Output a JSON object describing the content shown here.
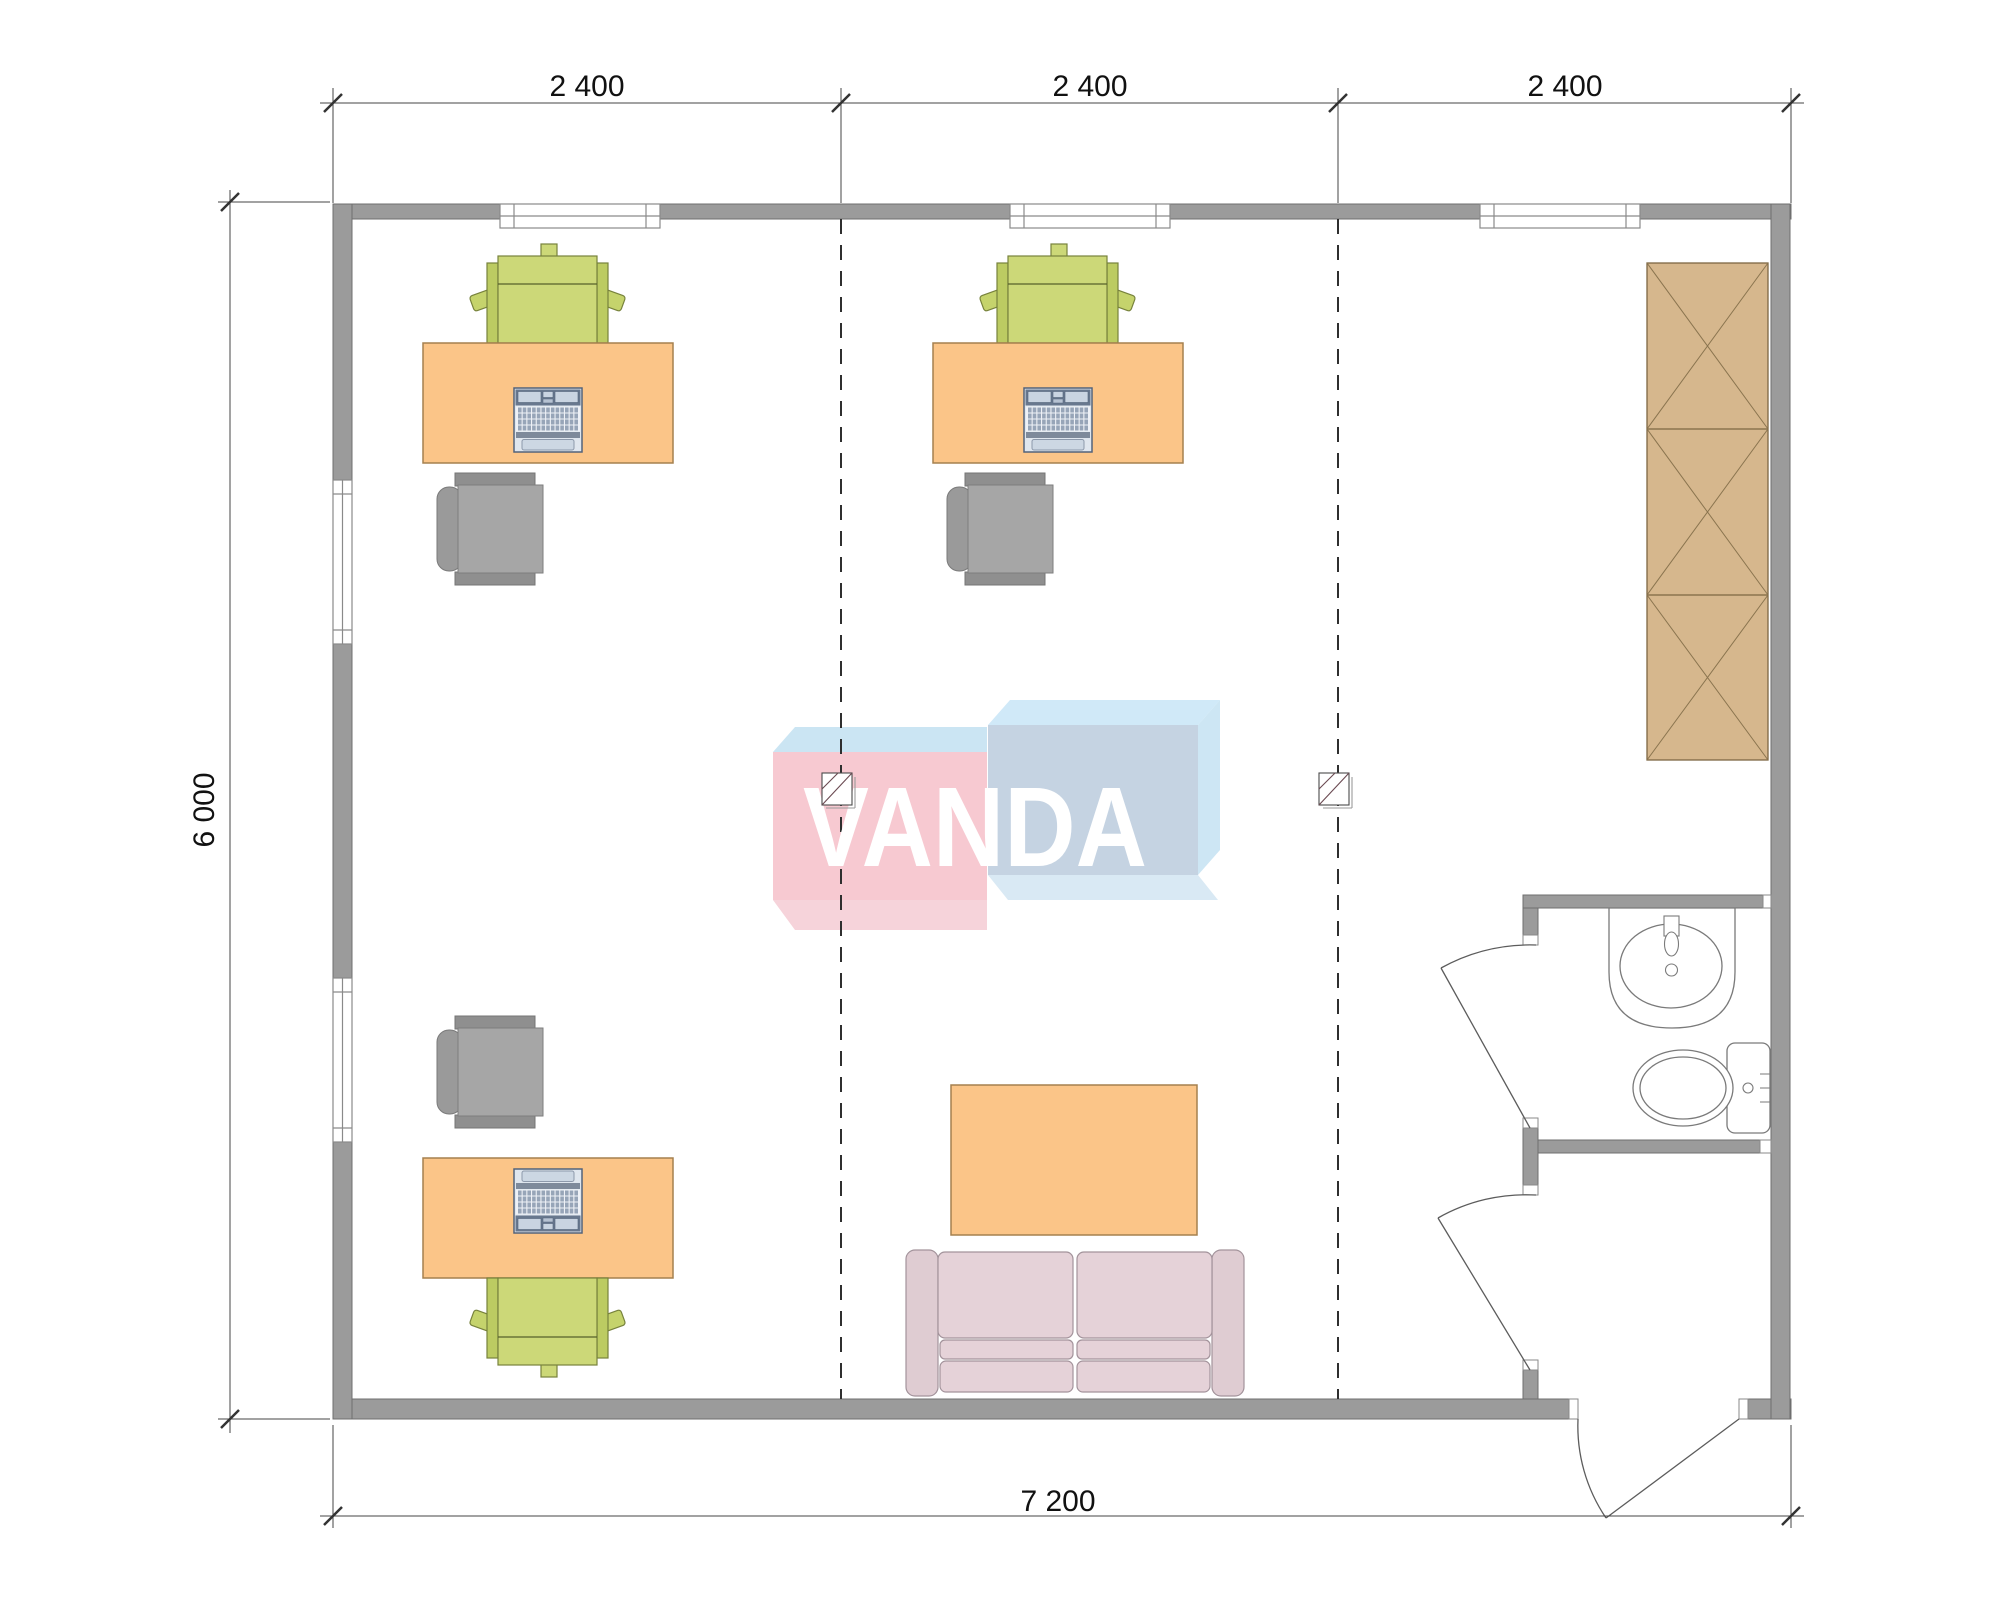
{
  "plan": {
    "dimension_labels": {
      "top": [
        "2 400",
        "2 400",
        "2 400"
      ],
      "left": "6 000",
      "bottom": "7 200"
    },
    "watermark": "VANDA",
    "colors": {
      "wall": "#9b9b9b",
      "desk_orange": "#fbc588",
      "chair_green": "#ccd878",
      "chair_gray": "#a6a6a6",
      "wardrobe_tan": "#d6b78d",
      "sofa_pink": "#e5d2d8",
      "laptop_blue": "#c9d4e1",
      "logo_pink": "#f7c9d1",
      "logo_blue_front": "#c5d3e2",
      "logo_light_blue": "#cbe5f3"
    }
  }
}
